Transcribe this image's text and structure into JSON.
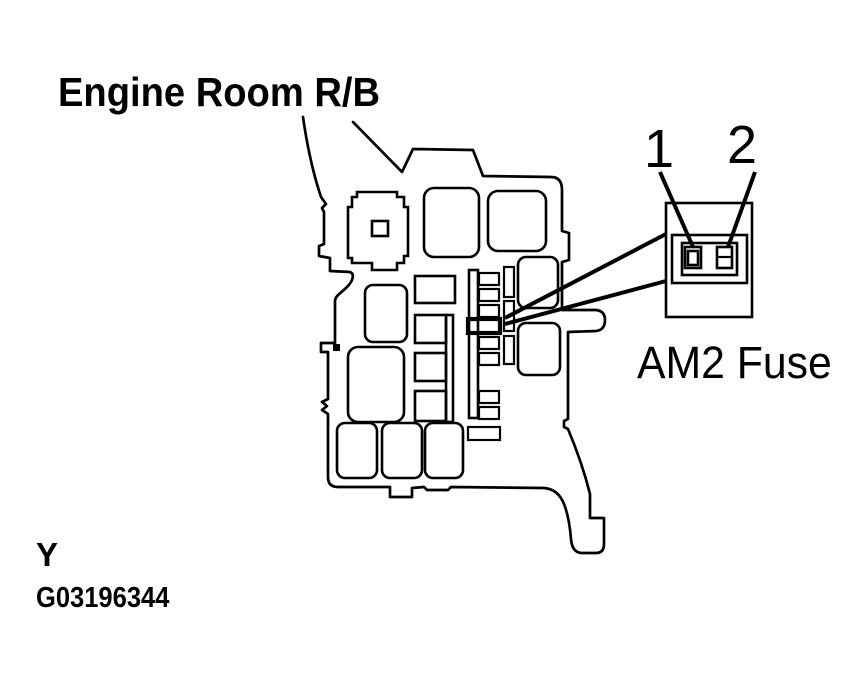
{
  "page": {
    "background": "#ffffff",
    "line_color": "#000000"
  },
  "title": "Engine Room R/B",
  "callout": {
    "pin_1": "1",
    "pin_2": "2",
    "fuse_name": "AM2 Fuse"
  },
  "footer": {
    "section_code": "Y",
    "figure_id": "G03196344"
  }
}
